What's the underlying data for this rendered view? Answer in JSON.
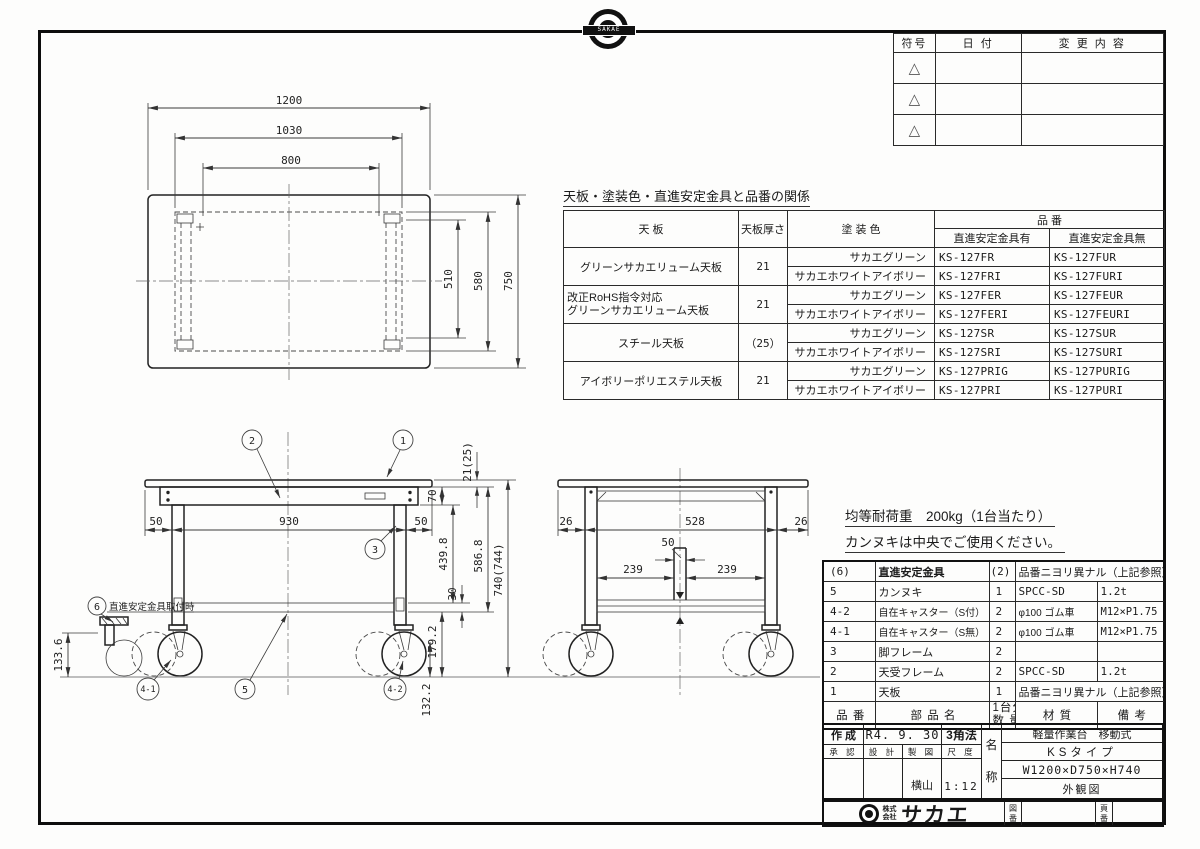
{
  "colors": {
    "line": "#1a1a1a",
    "background": "#fdfdfc"
  },
  "emblem": {
    "brand": "SAKAE"
  },
  "revision": {
    "col_symbol": "符号",
    "col_date": "日 付",
    "col_change": "変 更 内 容",
    "row_symbols": [
      "△",
      "△",
      "△"
    ]
  },
  "product_table": {
    "title": "天板・塗装色・直進安定金具と品番の関係",
    "h_tenban": "天 板",
    "h_thickness": "天板厚さ",
    "h_color": "塗 装 色",
    "h_hinban": "品 番",
    "h_with": "直進安定金具有",
    "h_without": "直進安定金具無",
    "groups": [
      {
        "tenban": "グリーンサカエリューム天板",
        "tenban2": "",
        "thickness": "21",
        "rows": [
          {
            "color": "サカエグリーン",
            "with": "KS-127FR",
            "without": "KS-127FUR"
          },
          {
            "color": "サカエホワイトアイボリー",
            "with": "KS-127FRI",
            "without": "KS-127FURI"
          }
        ]
      },
      {
        "tenban": "改正RoHS指令対応",
        "tenban2": "グリーンサカエリューム天板",
        "thickness": "21",
        "rows": [
          {
            "color": "サカエグリーン",
            "with": "KS-127FER",
            "without": "KS-127FEUR"
          },
          {
            "color": "サカエホワイトアイボリー",
            "with": "KS-127FERI",
            "without": "KS-127FEURI"
          }
        ]
      },
      {
        "tenban": "スチール天板",
        "tenban2": "",
        "thickness": "（25）",
        "rows": [
          {
            "color": "サカエグリーン",
            "with": "KS-127SR",
            "without": "KS-127SUR"
          },
          {
            "color": "サカエホワイトアイボリー",
            "with": "KS-127SRI",
            "without": "KS-127SURI"
          }
        ]
      },
      {
        "tenban": "アイボリーポリエステル天板",
        "tenban2": "",
        "thickness": "21",
        "rows": [
          {
            "color": "サカエグリーン",
            "with": "KS-127PRIG",
            "without": "KS-127PURIG"
          },
          {
            "color": "サカエホワイトアイボリー",
            "with": "KS-127PRI",
            "without": "KS-127PURI"
          }
        ]
      }
    ]
  },
  "notes": {
    "load": "均等耐荷重　200kg（1台当たり）",
    "usage": "カンヌキは中央でご使用ください。"
  },
  "parts": {
    "rows": [
      {
        "no": "(6)",
        "name": "直進安定金具",
        "qty": "(2)",
        "mat": "品番ニヨリ異ナル（上記参照）",
        "rem": ""
      },
      {
        "no": "5",
        "name": "カンヌキ",
        "qty": "1",
        "mat": "SPCC-SD",
        "rem": "1.2t"
      },
      {
        "no": "4-2",
        "name": "自在キャスター（S付）",
        "qty": "2",
        "mat": "φ100 ゴム車",
        "rem": "M12×P1.75"
      },
      {
        "no": "4-1",
        "name": "自在キャスター（S無）",
        "qty": "2",
        "mat": "φ100 ゴム車",
        "rem": "M12×P1.75"
      },
      {
        "no": "3",
        "name": "脚フレーム",
        "qty": "2",
        "mat": "",
        "rem": ""
      },
      {
        "no": "2",
        "name": "天受フレーム",
        "qty": "2",
        "mat": "SPCC-SD",
        "rem": "1.2t"
      },
      {
        "no": "1",
        "name": "天板",
        "qty": "1",
        "mat": "品番ニヨリ異ナル（上記参照）",
        "rem": ""
      }
    ],
    "f_no": "品 番",
    "f_name": "部 品 名",
    "f_qty1": "1台分",
    "f_qty2": "数 量",
    "f_mat": "材 質",
    "f_rem": "備 考"
  },
  "title_block": {
    "created_label": "作 成",
    "created_value": "R4. 9. 30",
    "projection": "3角法",
    "approved_label": "承 認",
    "designed_label": "設 計",
    "drawn_label": "製 図",
    "scale_label": "尺 度",
    "drawn_value": "横山",
    "scale_value": "1:12",
    "name_label": "名称",
    "product": "軽量作業台　移動式",
    "type": "KSタイプ",
    "size": "W1200×D750×H740",
    "view": "外観図"
  },
  "company": {
    "prefix_top": "株式",
    "prefix_bottom": "会社",
    "name": "サカエ",
    "drawing_no_label": "図番",
    "page_no_label": "頁番"
  },
  "drawing": {
    "top_view": {
      "dim_width_outer": "1200",
      "dim_width_frame": "1030",
      "dim_width_inner": "800",
      "dim_depth_outer": "750",
      "dim_depth_frame": "580",
      "dim_depth_inner": "510"
    },
    "front_view": {
      "dim_left_overhang": "50",
      "dim_leg_span": "930",
      "dim_right_overhang": "50",
      "dim_top_thickness": "21(25)",
      "dim_apron_height": "70",
      "dim_leg_height": "439.8",
      "dim_rail_height": "30",
      "dim_frame_height": "586.8",
      "dim_total_height": "740(744)",
      "dim_caster_height": "179.2",
      "dim_caster_bottom": "132.2",
      "dim_stabilizer_height": "133.6",
      "stabilizer_note": "直進安定金具取付時",
      "callout_1": "1",
      "callout_2": "2",
      "callout_3": "3",
      "callout_5": "5",
      "callout_6": "6",
      "callout_41": "4-1",
      "callout_42": "4-2"
    },
    "side_view": {
      "dim_left_overhang": "26",
      "dim_leg_span": "528",
      "dim_right_overhang": "26",
      "dim_center_width": "50",
      "dim_half_left": "239",
      "dim_half_right": "239"
    }
  }
}
